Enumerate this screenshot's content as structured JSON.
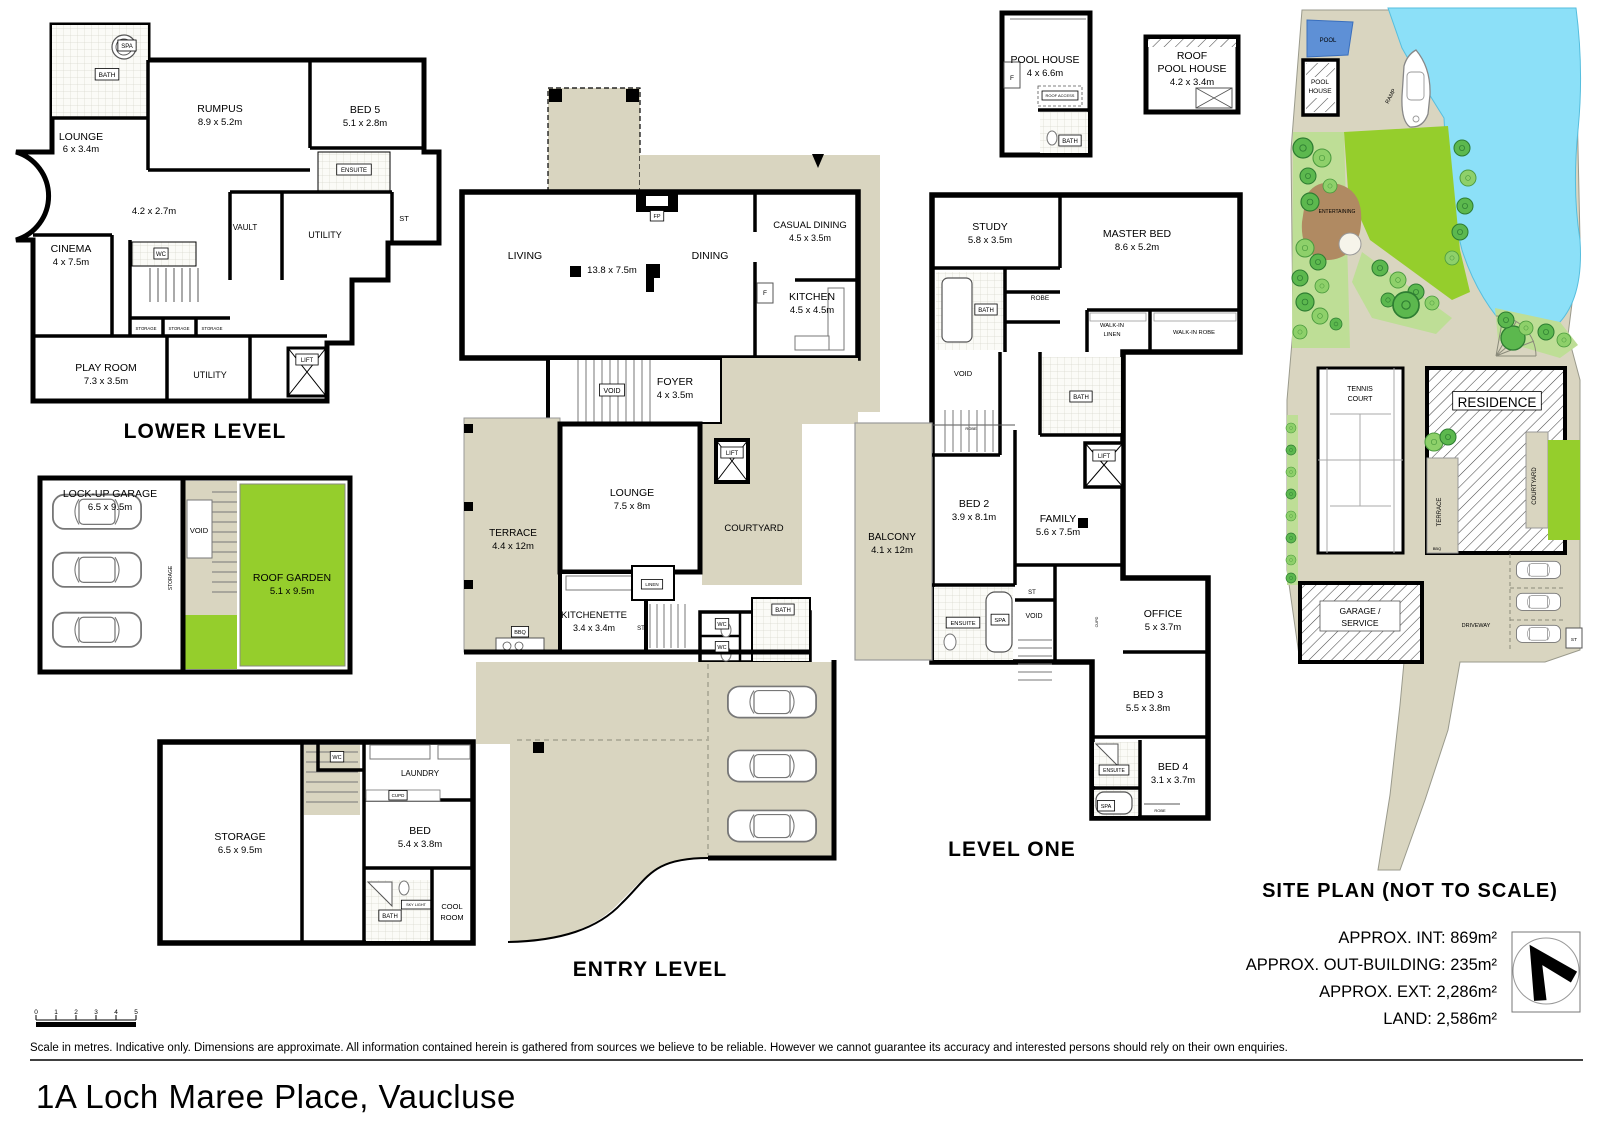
{
  "page": {
    "title": "1A Loch Maree Place, Vaucluse",
    "disclaimer": "Scale in metres. Indicative only. Dimensions are approximate. All information contained herein is gathered from sources we believe to be reliable. However we cannot guarantee its accuracy and interested persons should rely on their own enquiries."
  },
  "footer": {
    "scale_ticks": [
      {
        "t": "0",
        "x": 36,
        "y": 1014,
        "s": 6.5
      },
      {
        "t": "1",
        "x": 56,
        "y": 1014,
        "s": 6.5
      },
      {
        "t": "2",
        "x": 76,
        "y": 1014,
        "s": 6.5
      },
      {
        "t": "3",
        "x": 96,
        "y": 1014,
        "s": 6.5
      },
      {
        "t": "4",
        "x": 116,
        "y": 1014,
        "s": 6.5
      },
      {
        "t": "5",
        "x": 136,
        "y": 1014,
        "s": 6.5
      }
    ]
  },
  "levels": {
    "lower": {
      "title": "LOWER LEVEL",
      "labels": [
        {
          "t": "SPA",
          "x": 127,
          "y": 48,
          "s": 6,
          "box": true
        },
        {
          "t": "BATH",
          "x": 107,
          "y": 77,
          "s": 6.5,
          "box": true
        },
        {
          "t": "LOUNGE",
          "x": 81,
          "y": 140,
          "s": 10.5
        },
        {
          "t": "6 x 3.4m",
          "x": 81,
          "y": 152,
          "s": 9.5
        },
        {
          "t": "RUMPUS",
          "x": 220,
          "y": 112,
          "s": 10.5
        },
        {
          "t": "8.9 x 5.2m",
          "x": 220,
          "y": 125,
          "s": 9.5
        },
        {
          "t": "BED 5",
          "x": 365,
          "y": 113,
          "s": 10.5
        },
        {
          "t": "5.1 x 2.8m",
          "x": 365,
          "y": 126,
          "s": 9.5
        },
        {
          "t": "ENSUITE",
          "x": 354,
          "y": 172,
          "s": 6,
          "box": true
        },
        {
          "t": "ST",
          "x": 404,
          "y": 221,
          "s": 7.5
        },
        {
          "t": "4.2 x 2.7m",
          "x": 154,
          "y": 214,
          "s": 9.5
        },
        {
          "t": "VAULT",
          "x": 245,
          "y": 230,
          "s": 8
        },
        {
          "t": "UTILITY",
          "x": 325,
          "y": 238,
          "s": 9
        },
        {
          "t": "CINEMA",
          "x": 71,
          "y": 252,
          "s": 10.5
        },
        {
          "t": "4 x 7.5m",
          "x": 71,
          "y": 265,
          "s": 9.5
        },
        {
          "t": "WC",
          "x": 161,
          "y": 256,
          "s": 6,
          "box": true
        },
        {
          "t": "STORAGE",
          "x": 146,
          "y": 330,
          "s": 4.3
        },
        {
          "t": "STORAGE",
          "x": 179,
          "y": 330,
          "s": 4.3
        },
        {
          "t": "STORAGE",
          "x": 212,
          "y": 330,
          "s": 4.3
        },
        {
          "t": "PLAY ROOM",
          "x": 106,
          "y": 371,
          "s": 10.5
        },
        {
          "t": "7.3 x 3.5m",
          "x": 106,
          "y": 384,
          "s": 9.5
        },
        {
          "t": "UTILITY",
          "x": 210,
          "y": 378,
          "s": 9
        },
        {
          "t": "LIFT",
          "x": 307,
          "y": 362,
          "s": 6,
          "box": true
        }
      ]
    },
    "garage": {
      "labels": [
        {
          "t": "LOCK-UP GARAGE",
          "x": 110,
          "y": 497,
          "s": 10.5
        },
        {
          "t": "6.5 x 9.5m",
          "x": 110,
          "y": 510,
          "s": 9.5
        },
        {
          "t": "VOID",
          "x": 199,
          "y": 533,
          "s": 7.5
        },
        {
          "t": "STORAGE",
          "x": 172,
          "y": 578,
          "s": 5,
          "r": -90
        },
        {
          "t": "ROOF GARDEN",
          "x": 292,
          "y": 581,
          "s": 10.5
        },
        {
          "t": "5.1 x 9.5m",
          "x": 292,
          "y": 594,
          "s": 9.5
        }
      ]
    },
    "entry": {
      "title": "ENTRY LEVEL",
      "labels": [
        {
          "t": "LIVING",
          "x": 525,
          "y": 259,
          "s": 10.5
        },
        {
          "t": "13.8 x 7.5m",
          "x": 612,
          "y": 273,
          "s": 9.5
        },
        {
          "t": "DINING",
          "x": 710,
          "y": 259,
          "s": 10.5
        },
        {
          "t": "FP",
          "x": 657,
          "y": 218,
          "s": 5.5,
          "box": true
        },
        {
          "t": "CASUAL DINING",
          "x": 810,
          "y": 228,
          "s": 9.5
        },
        {
          "t": "4.5 x 3.5m",
          "x": 810,
          "y": 241,
          "s": 9
        },
        {
          "t": "KITCHEN",
          "x": 812,
          "y": 300,
          "s": 10.5
        },
        {
          "t": "4.5 x 4.5m",
          "x": 812,
          "y": 313,
          "s": 9.5
        },
        {
          "t": "F",
          "x": 765,
          "y": 295,
          "s": 6.5
        },
        {
          "t": "FOYER",
          "x": 675,
          "y": 385,
          "s": 10.5
        },
        {
          "t": "4 x 3.5m",
          "x": 675,
          "y": 398,
          "s": 9.5
        },
        {
          "t": "VOID",
          "x": 612,
          "y": 393,
          "s": 7,
          "box": true
        },
        {
          "t": "LOUNGE",
          "x": 632,
          "y": 496,
          "s": 10.5
        },
        {
          "t": "7.5 x 8m",
          "x": 632,
          "y": 509,
          "s": 9.5
        },
        {
          "t": "TERRACE",
          "x": 513,
          "y": 536,
          "s": 10
        },
        {
          "t": "4.4 x 12m",
          "x": 513,
          "y": 549,
          "s": 9.5
        },
        {
          "t": "COURTYARD",
          "x": 754,
          "y": 531,
          "s": 9.5
        },
        {
          "t": "LIFT",
          "x": 732,
          "y": 455,
          "s": 6,
          "box": true
        },
        {
          "t": "KITCHENETTE",
          "x": 594,
          "y": 618,
          "s": 9.5
        },
        {
          "t": "3.4 x 3.4m",
          "x": 594,
          "y": 631,
          "s": 9
        },
        {
          "t": "LINEN",
          "x": 652,
          "y": 586,
          "s": 4.5,
          "box": true
        },
        {
          "t": "ST",
          "x": 641,
          "y": 630,
          "s": 6
        },
        {
          "t": "WC",
          "x": 722,
          "y": 626,
          "s": 5.5,
          "box": true
        },
        {
          "t": "WC",
          "x": 722,
          "y": 649,
          "s": 5.5,
          "box": true
        },
        {
          "t": "BATH",
          "x": 783,
          "y": 612,
          "s": 6,
          "box": true
        },
        {
          "t": "BBQ",
          "x": 520,
          "y": 634,
          "s": 5.5,
          "box": true
        },
        {
          "t": "STORAGE",
          "x": 240,
          "y": 840,
          "s": 10.5
        },
        {
          "t": "6.5 x 9.5m",
          "x": 240,
          "y": 853,
          "s": 9.5
        },
        {
          "t": "WC",
          "x": 337,
          "y": 759,
          "s": 5.5,
          "box": true
        },
        {
          "t": "LAUNDRY",
          "x": 420,
          "y": 776,
          "s": 8
        },
        {
          "t": "CUPD",
          "x": 398,
          "y": 797,
          "s": 4.5,
          "box": true
        },
        {
          "t": "BED",
          "x": 420,
          "y": 834,
          "s": 10.5
        },
        {
          "t": "5.4 x 3.8m",
          "x": 420,
          "y": 847,
          "s": 9.5
        },
        {
          "t": "BATH",
          "x": 390,
          "y": 918,
          "s": 6,
          "box": true
        },
        {
          "t": "SKY LIGHT",
          "x": 416,
          "y": 906,
          "s": 3.8,
          "box": true
        },
        {
          "t": "COOL",
          "x": 452,
          "y": 909,
          "s": 7.5
        },
        {
          "t": "ROOM",
          "x": 452,
          "y": 920,
          "s": 7.5
        }
      ]
    },
    "level_one": {
      "title": "LEVEL ONE",
      "labels": [
        {
          "t": "POOL HOUSE",
          "x": 1045,
          "y": 63,
          "s": 10.5
        },
        {
          "t": "4 x 6.6m",
          "x": 1045,
          "y": 76,
          "s": 9.5
        },
        {
          "t": "F",
          "x": 1012,
          "y": 80,
          "s": 6.5
        },
        {
          "t": "ROOF ACCESS",
          "x": 1060,
          "y": 97,
          "s": 4,
          "box": true
        },
        {
          "t": "BATH",
          "x": 1070,
          "y": 143,
          "s": 6,
          "box": true
        },
        {
          "t": "ROOF",
          "x": 1192,
          "y": 59,
          "s": 10.5
        },
        {
          "t": "POOL HOUSE",
          "x": 1192,
          "y": 72,
          "s": 10.5
        },
        {
          "t": "4.2 x 3.4m",
          "x": 1192,
          "y": 85,
          "s": 9.5
        },
        {
          "t": "STUDY",
          "x": 990,
          "y": 230,
          "s": 10.5
        },
        {
          "t": "5.8 x 3.5m",
          "x": 990,
          "y": 243,
          "s": 9.5
        },
        {
          "t": "MASTER BED",
          "x": 1137,
          "y": 237,
          "s": 10.5
        },
        {
          "t": "8.6 x 5.2m",
          "x": 1137,
          "y": 250,
          "s": 9.5
        },
        {
          "t": "BATH",
          "x": 986,
          "y": 312,
          "s": 6,
          "box": true
        },
        {
          "t": "ROBE",
          "x": 1040,
          "y": 300,
          "s": 6.5
        },
        {
          "t": "WALK-IN",
          "x": 1112,
          "y": 327,
          "s": 5.8
        },
        {
          "t": "LINEN",
          "x": 1112,
          "y": 336,
          "s": 5.8
        },
        {
          "t": "WALK-IN ROBE",
          "x": 1194,
          "y": 334,
          "s": 5.8
        },
        {
          "t": "VOID",
          "x": 963,
          "y": 376,
          "s": 7.5
        },
        {
          "t": "BATH",
          "x": 1081,
          "y": 399,
          "s": 6,
          "box": true
        },
        {
          "t": "LIFT",
          "x": 1104,
          "y": 458,
          "s": 6,
          "box": true
        },
        {
          "t": "ROBE",
          "x": 971,
          "y": 430,
          "s": 4
        },
        {
          "t": "BED 2",
          "x": 974,
          "y": 507,
          "s": 10.5
        },
        {
          "t": "3.9 x 8.1m",
          "x": 974,
          "y": 520,
          "s": 9.5
        },
        {
          "t": "FAMILY",
          "x": 1058,
          "y": 522,
          "s": 10.5
        },
        {
          "t": "5.6 x 7.5m",
          "x": 1058,
          "y": 535,
          "s": 9.5
        },
        {
          "t": "BALCONY",
          "x": 892,
          "y": 540,
          "s": 10
        },
        {
          "t": "4.1 x 12m",
          "x": 892,
          "y": 553,
          "s": 9.5
        },
        {
          "t": "ST",
          "x": 1032,
          "y": 594,
          "s": 6
        },
        {
          "t": "VOID",
          "x": 1034,
          "y": 618,
          "s": 7
        },
        {
          "t": "ENSUITE",
          "x": 963,
          "y": 625,
          "s": 5.8,
          "box": true
        },
        {
          "t": "SPA",
          "x": 1000,
          "y": 622,
          "s": 5.8,
          "box": true
        },
        {
          "t": "CUPD",
          "x": 1098,
          "y": 622,
          "s": 3.8,
          "r": -90
        },
        {
          "t": "OFFICE",
          "x": 1163,
          "y": 617,
          "s": 10.5
        },
        {
          "t": "5 x 3.7m",
          "x": 1163,
          "y": 630,
          "s": 9.5
        },
        {
          "t": "BED 3",
          "x": 1148,
          "y": 698,
          "s": 10.5
        },
        {
          "t": "5.5 x 3.8m",
          "x": 1148,
          "y": 711,
          "s": 9.5
        },
        {
          "t": "BED 4",
          "x": 1173,
          "y": 770,
          "s": 10.5
        },
        {
          "t": "3.1 x 3.7m",
          "x": 1173,
          "y": 783,
          "s": 9.5
        },
        {
          "t": "ENSUITE",
          "x": 1114,
          "y": 772,
          "s": 5,
          "box": true
        },
        {
          "t": "SPA",
          "x": 1106,
          "y": 808,
          "s": 5.5,
          "box": true
        },
        {
          "t": "ROBE",
          "x": 1160,
          "y": 812,
          "s": 4
        }
      ]
    },
    "site": {
      "title": "SITE PLAN (NOT TO SCALE)",
      "stats": [
        "APPROX. INT:  869m²",
        "APPROX. OUT-BUILDING:  235m²",
        "APPROX. EXT: 2,286m²",
        "LAND: 2,586m²"
      ],
      "labels": [
        {
          "t": "POOL",
          "x": 1328,
          "y": 42,
          "s": 6
        },
        {
          "t": "POOL",
          "x": 1320,
          "y": 84,
          "s": 6.5
        },
        {
          "t": "HOUSE",
          "x": 1320,
          "y": 93,
          "s": 6.5
        },
        {
          "t": "RAMP",
          "x": 1392,
          "y": 97,
          "s": 5.5,
          "r": -62
        },
        {
          "t": "ENTERTAINING",
          "x": 1337,
          "y": 213,
          "s": 5
        },
        {
          "t": "TENNIS",
          "x": 1360,
          "y": 391,
          "s": 7
        },
        {
          "t": "COURT",
          "x": 1360,
          "y": 401,
          "s": 7
        },
        {
          "t": "RESIDENCE",
          "x": 1497,
          "y": 407,
          "s": 13.5,
          "box": true
        },
        {
          "t": "TERRACE",
          "x": 1441,
          "y": 512,
          "s": 6,
          "r": -90
        },
        {
          "t": "COURTYARD",
          "x": 1536,
          "y": 486,
          "s": 6,
          "r": -90
        },
        {
          "t": "BBQ",
          "x": 1437,
          "y": 550,
          "s": 4
        },
        {
          "t": "GARAGE /",
          "x": 1360,
          "y": 614,
          "s": 8.5
        },
        {
          "t": "SERVICE",
          "x": 1360,
          "y": 626,
          "s": 8.5
        },
        {
          "t": "DRIVEWAY",
          "x": 1476,
          "y": 627,
          "s": 5.5
        },
        {
          "t": "ST",
          "x": 1574,
          "y": 641,
          "s": 4.8
        },
        {
          "t": "N",
          "x": 1553,
          "y": 1000,
          "s": 23,
          "b": true,
          "r": -32
        }
      ]
    }
  }
}
